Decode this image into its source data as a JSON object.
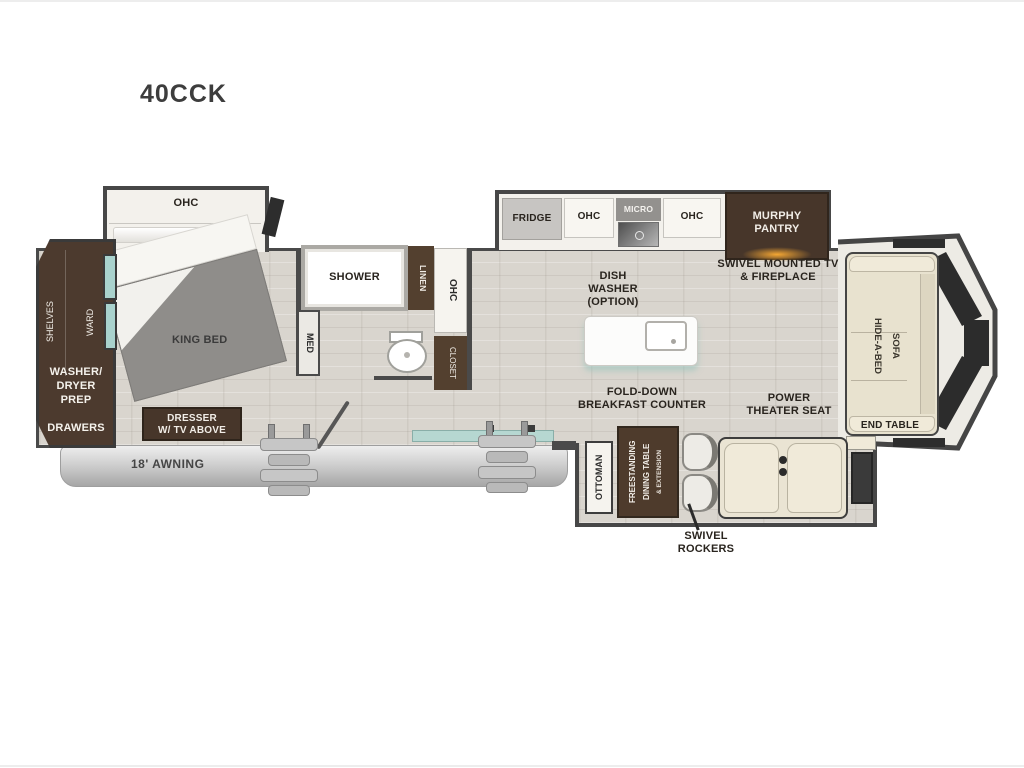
{
  "title": "40CCK",
  "front_closet": {
    "shelves_label": "SHELVES",
    "ward_label": "WARD",
    "washer_dryer_label": "WASHER/\nDRYER\nPREP",
    "drawers_label": "DRAWERS"
  },
  "bedroom": {
    "ohc_label": "OHC",
    "bed_label": "KING BED",
    "dresser_label": "DRESSER\nW/ TV ABOVE"
  },
  "bathroom": {
    "shower_label": "SHOWER",
    "linen_label": "LINEN",
    "ohc_label": "OHC",
    "med_label": "MED",
    "closet_label": "CLOSET"
  },
  "kitchen": {
    "fridge_label": "FRIDGE",
    "ohc_left_label": "OHC",
    "micro_label": "MICRO",
    "ohc_right_label": "OHC",
    "murphy_pantry_label": "MURPHY\nPANTRY",
    "dishwasher_label": "DISH\nWASHER\n(OPTION)",
    "breakfast_counter_label": "FOLD-DOWN\nBREAKFAST COUNTER"
  },
  "living": {
    "tv_fireplace_label": "SWIVEL MOUNTED TV\n& FIREPLACE",
    "sofa_line1": "HIDE-A-BED",
    "sofa_line2": "SOFA",
    "end_table_label": "END TABLE",
    "theater_seat_label": "POWER\nTHEATER SEAT"
  },
  "rear_slide": {
    "ottoman_label": "OTTOMAN",
    "dining_line1": "FREESTANDING",
    "dining_line2": "DINING TABLE",
    "dining_line3": "& EXTENSION",
    "swivel_rockers_label": "SWIVEL\nROCKERS"
  },
  "exterior": {
    "awning_label": "18' AWNING"
  },
  "colors": {
    "cabinet_brown": "#47362a",
    "floor_light": "#d9d5ce",
    "wall_dark": "#4a4a4a",
    "teal_accent": "#a9d2cd",
    "bed_gray": "#8f8d8a",
    "sofa_cream": "#e8e2cf",
    "window_dark": "#2d2d2d",
    "fireplace_glow": "#f5a733"
  }
}
